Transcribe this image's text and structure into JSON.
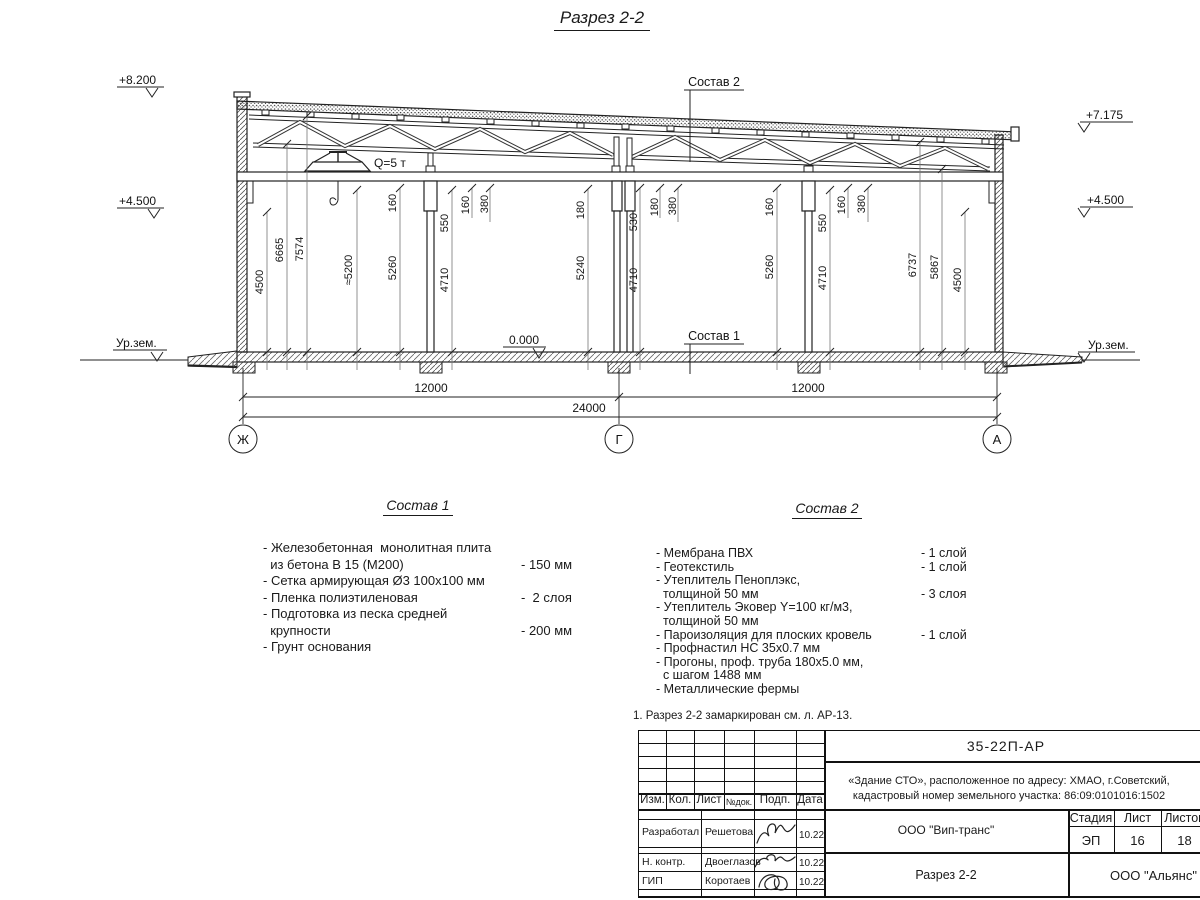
{
  "page": {
    "title": "Разрез 2-2",
    "note": "1. Разрез 2-2 замаркирован см. л. АР-13."
  },
  "section": {
    "elev_left_top": "+8.200",
    "elev_left_mid": "+4.500",
    "elev_left_ground": "Ур.зем.",
    "elev_right_top": "+7.175",
    "elev_right_mid": "+4.500",
    "elev_right_ground": "Ур.зем.",
    "zero_mark": "0.000",
    "crane_label": "Q=5 т",
    "leader_roof": "Состав 2",
    "leader_floor": "Состав 1",
    "axis_left": "Ж",
    "axis_mid": "Г",
    "axis_right": "А",
    "dim_span_left": "12000",
    "dim_span_right": "12000",
    "dim_total": "24000",
    "vdims": [
      {
        "t": "4500"
      },
      {
        "t": "6665"
      },
      {
        "t": "7574"
      },
      {
        "t": "≈5200"
      },
      {
        "t": "5260"
      },
      {
        "t": "160"
      },
      {
        "t": "550"
      },
      {
        "t": "4710"
      },
      {
        "t": "160"
      },
      {
        "t": "380"
      },
      {
        "t": "180"
      },
      {
        "t": "5240"
      },
      {
        "t": "530"
      },
      {
        "t": "4710"
      },
      {
        "t": "180"
      },
      {
        "t": "380"
      },
      {
        "t": "160"
      },
      {
        "t": "5260"
      },
      {
        "t": "550"
      },
      {
        "t": "4710"
      },
      {
        "t": "160"
      },
      {
        "t": "380"
      },
      {
        "t": "6737"
      },
      {
        "t": "5867"
      },
      {
        "t": "4500"
      }
    ]
  },
  "comp1": {
    "title": "Состав 1",
    "items": [
      {
        "t": "- Железобетонная  монолитная плита",
        "v": ""
      },
      {
        "t": "  из бетона В 15 (М200)",
        "v": "- 150 мм"
      },
      {
        "t": "- Сетка армирующая Ø3 100х100 мм",
        "v": ""
      },
      {
        "t": "- Пленка полиэтиленовая",
        "v": "-  2 слоя"
      },
      {
        "t": "- Подготовка из песка средней",
        "v": ""
      },
      {
        "t": "  крупности",
        "v": "- 200 мм"
      },
      {
        "t": "- Грунт основания",
        "v": ""
      }
    ]
  },
  "comp2": {
    "title": "Состав 2",
    "items": [
      {
        "t": "- Мембрана ПВХ",
        "v": "- 1 слой"
      },
      {
        "t": "- Геотекстиль",
        "v": "- 1 слой"
      },
      {
        "t": "- Утеплитель Пеноплэкс,",
        "v": ""
      },
      {
        "t": "  толщиной 50 мм",
        "v": "- 3 слоя"
      },
      {
        "t": "- Утеплитель Эковер Y=100 кг/м3,",
        "v": ""
      },
      {
        "t": "  толщиной 50 мм",
        "v": "- 1 слой"
      },
      {
        "t": "- Пароизоляция для плоских кровель",
        "v": "- 1 слой"
      },
      {
        "t": "- Профнастил НС 35х0.7 мм",
        "v": ""
      },
      {
        "t": "- Прогоны, проф. труба 180х5.0 мм,",
        "v": ""
      },
      {
        "t": "  с шагом 1488 мм",
        "v": ""
      },
      {
        "t": "- Металлические фермы",
        "v": ""
      }
    ]
  },
  "titleblock": {
    "doc_number": "35-22П-АР",
    "project_line1": "«Здание СТО», расположенное по адресу: ХМАО, г.Советский,",
    "project_line2": "кадастровый номер земельного участка: 86:09:0101016:1502",
    "col_izm": "Изм.",
    "col_kol": "Кол.",
    "col_list": "Лист",
    "col_ndoc": "№док.",
    "col_podp": "Подп.",
    "col_data": "Дата",
    "row1_role": "Разработал",
    "row1_name": "Решетова",
    "row1_date": "10.22",
    "row2_role": "Н. контр.",
    "row2_name": "Двоеглазов",
    "row2_date": "10.22",
    "row3_role": "ГИП",
    "row3_name": "Коротаев",
    "row3_date": "10.22",
    "org": "ООО \"Вип-транс\"",
    "stage_label": "Стадия",
    "sheet_label": "Лист",
    "sheets_label": "Листов",
    "stage": "ЭП",
    "sheet_no": "16",
    "sheets_total": "18",
    "drawing_name": "Разрез 2-2",
    "company": "ООО \"Альянс\""
  }
}
